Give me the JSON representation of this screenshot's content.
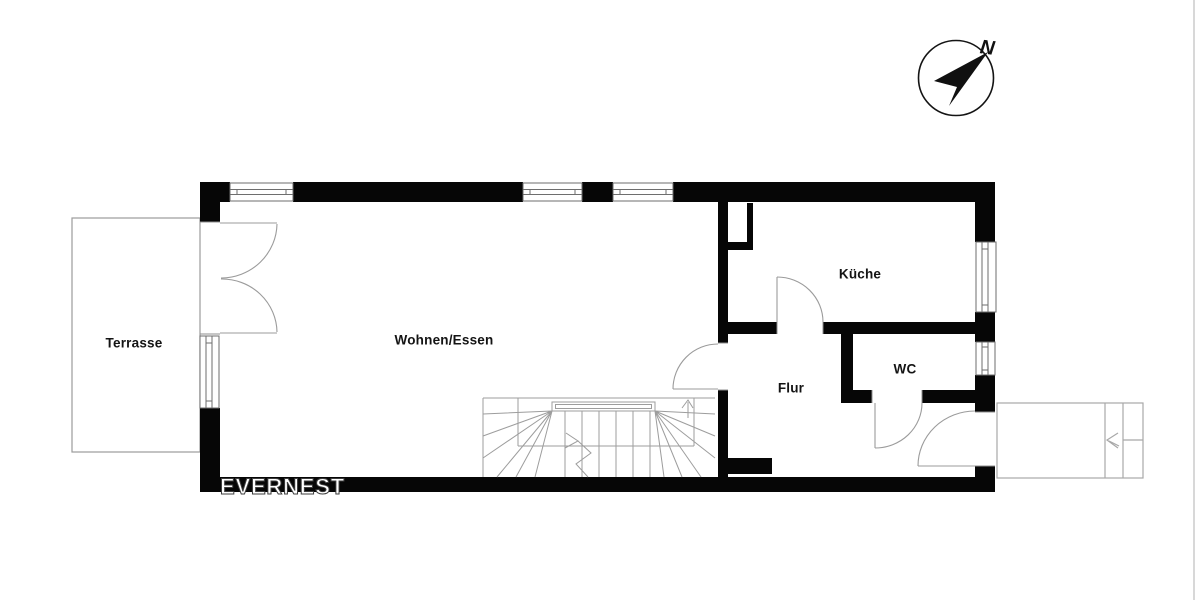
{
  "page": {
    "width": 1200,
    "height": 600,
    "background": "#ffffff"
  },
  "branding": {
    "logo_text": "EVERNEST"
  },
  "compass": {
    "direction_label": "N"
  },
  "rooms": [
    {
      "id": "terrasse",
      "label": "Terrasse"
    },
    {
      "id": "wohnen-essen",
      "label": "Wohnen/Essen"
    },
    {
      "id": "kueche",
      "label": "Küche"
    },
    {
      "id": "flur",
      "label": "Flur"
    },
    {
      "id": "wc",
      "label": "WC"
    }
  ],
  "colors": {
    "wall": "#060606",
    "thin_line": "#9b9b9b",
    "window_line": "#6e6e6e",
    "stoop_line": "#a8a8a8",
    "page_edge": "#d8d8d8",
    "label_text": "#141414",
    "logo_text": "#ffffff"
  }
}
